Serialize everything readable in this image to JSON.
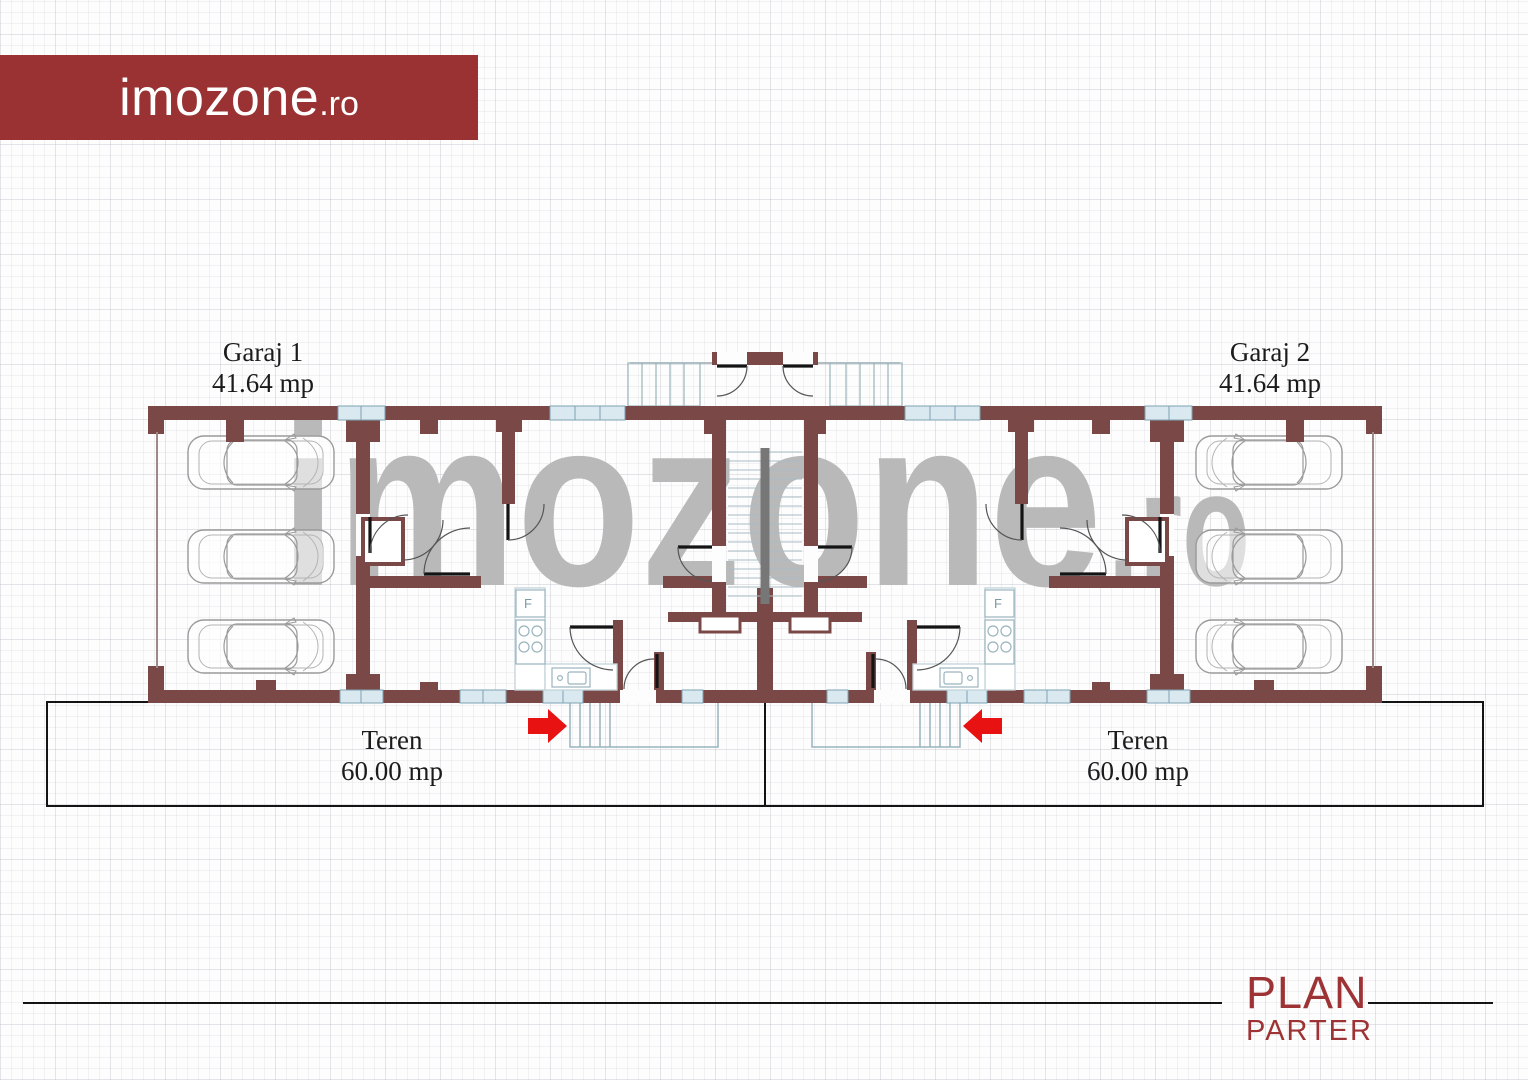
{
  "banner": {
    "text_main": "imozone",
    "text_suffix": ".ro",
    "color": "#9a3132"
  },
  "watermark": {
    "text_main": "imozone",
    "text_suffix": ".ro",
    "color": "#b9b9b9"
  },
  "plan": {
    "garage_left": {
      "name": "Garaj 1",
      "area": "41.64 mp"
    },
    "garage_right": {
      "name": "Garaj 2",
      "area": "41.64 mp"
    },
    "land_left": {
      "name": "Teren",
      "area": "60.00 mp"
    },
    "land_right": {
      "name": "Teren",
      "area": "60.00 mp"
    },
    "fridge_label": "F",
    "wall_color": "#7a4846",
    "window_color": "#d9e9ef",
    "arrow_color": "#e81212"
  },
  "footer": {
    "title": "PLAN",
    "subtitle": "PARTER",
    "color": "#9d3335"
  }
}
